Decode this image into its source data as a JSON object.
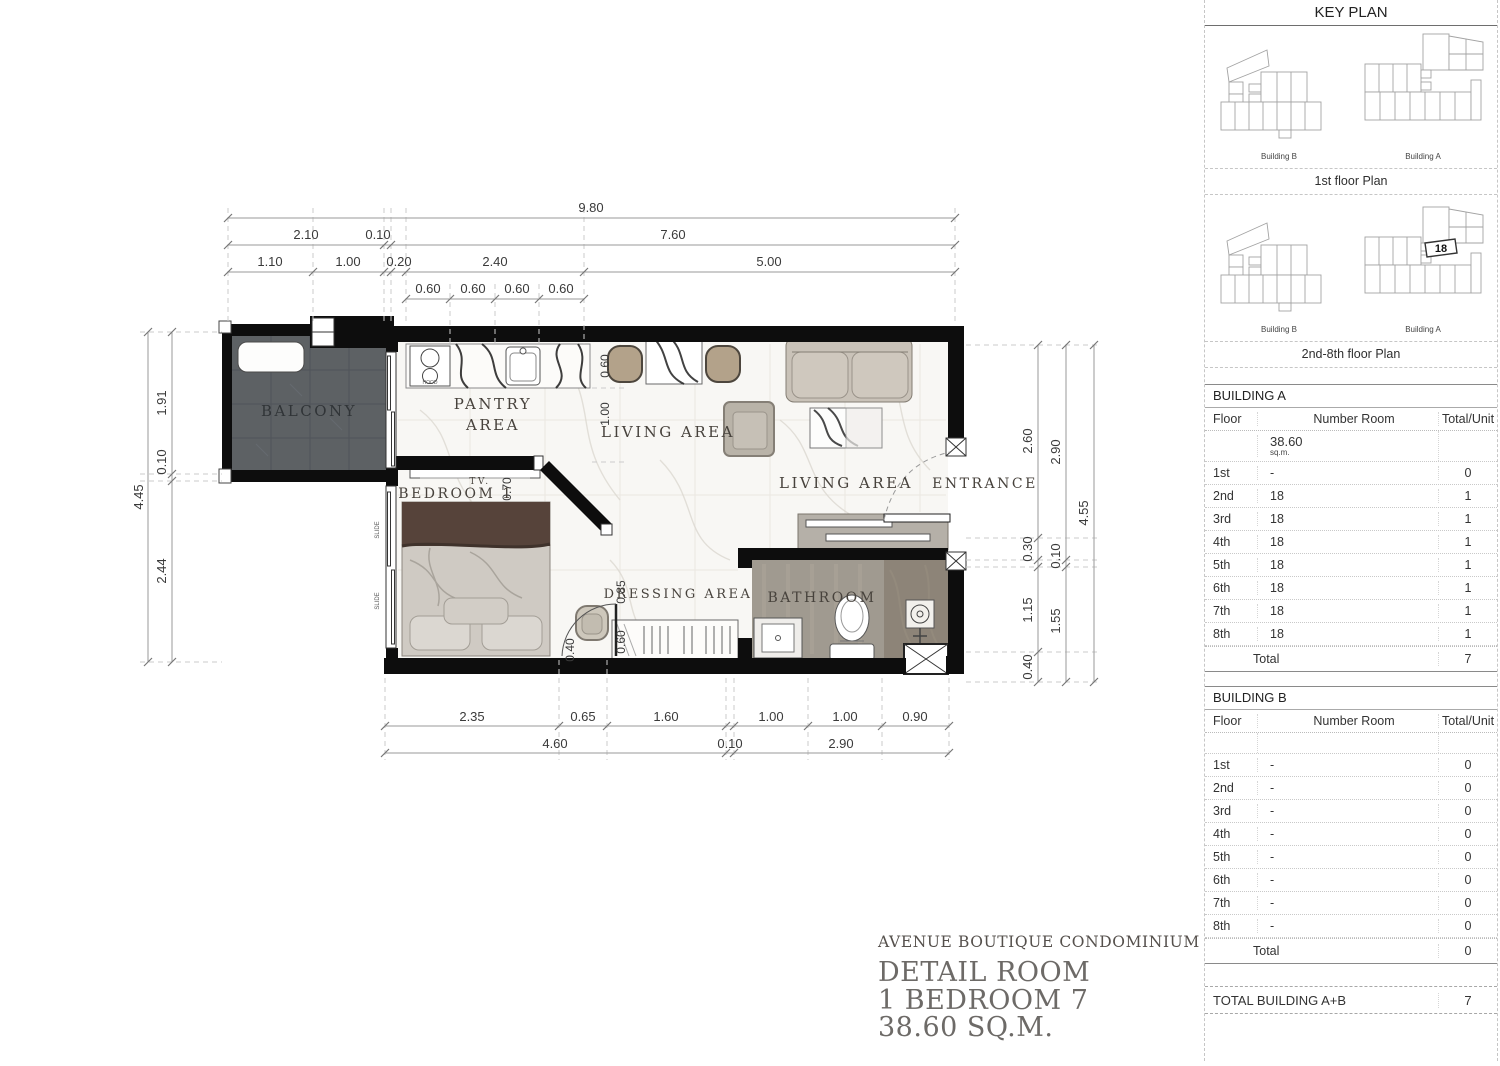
{
  "plan": {
    "rooms": {
      "balcony": "BALCONY",
      "pantry1": "PANTRY",
      "pantry2": "AREA",
      "living_top": "LIVING AREA",
      "living_main": "LIVING AREA",
      "entrance": "ENTRANCE",
      "bedroom": "BEDROOM 1",
      "dressing": "DRESSING AREA",
      "bathroom": "BATHROOM"
    },
    "annotations": {
      "tv": "TV.",
      "slide": "SLIDE",
      "hood": "HOOD"
    },
    "dims": {
      "top_total": "9.80",
      "top_r2": [
        "2.10",
        "0.10",
        "7.60"
      ],
      "top_r3": [
        "1.10",
        "1.00",
        "0.20",
        "2.40",
        "5.00"
      ],
      "top_r4": [
        "0.60",
        "0.60",
        "0.60",
        "0.60"
      ],
      "bottom_r1": [
        "2.35",
        "0.65",
        "1.60",
        "1.00",
        "1.00",
        "0.90"
      ],
      "bottom_r2": [
        "4.60",
        "0.10",
        "2.90"
      ],
      "left_total": "4.45",
      "left_inner": [
        "1.91",
        "0.10",
        "2.44"
      ],
      "right_inner": [
        "2.60",
        "0.30",
        "1.15",
        "0.40"
      ],
      "right_mid": [
        "2.90",
        "0.10",
        "1.55"
      ],
      "right_total": "4.55",
      "interior": {
        "pantry_depth": "0.60",
        "pantry_gap": "1.00",
        "tv": "0.70",
        "dressing": "0.85",
        "rack": "0.60",
        "bed_gap": "0.40"
      }
    }
  },
  "title_block": {
    "project": "AVENUE BOUTIQUE CONDOMINIUM",
    "line1": "DETAIL ROOM",
    "line2": "1 BEDROOM 7",
    "line3": "38.60 SQ.M."
  },
  "sidebar": {
    "title": "KEY PLAN",
    "plan1": {
      "caption": "1st floor Plan",
      "label_b": "Building B",
      "label_a": "Building A"
    },
    "plan2": {
      "caption": "2nd-8th floor Plan",
      "label_b": "Building B",
      "label_a": "Building A",
      "unit": "18"
    },
    "building_a": {
      "title": "BUILDING  A",
      "col_floor": "Floor",
      "col_room": "Number Room",
      "col_total": "Total/Unit",
      "area": "38.60",
      "area_unit": "sq.m.",
      "rows": [
        {
          "f": "1st",
          "r": "-",
          "u": "0"
        },
        {
          "f": "2nd",
          "r": "18",
          "u": "1"
        },
        {
          "f": "3rd",
          "r": "18",
          "u": "1"
        },
        {
          "f": "4th",
          "r": "18",
          "u": "1"
        },
        {
          "f": "5th",
          "r": "18",
          "u": "1"
        },
        {
          "f": "6th",
          "r": "18",
          "u": "1"
        },
        {
          "f": "7th",
          "r": "18",
          "u": "1"
        },
        {
          "f": "8th",
          "r": "18",
          "u": "1"
        }
      ],
      "total_label": "Total",
      "total_value": "7"
    },
    "building_b": {
      "title": "BUILDING  B",
      "col_floor": "Floor",
      "col_room": "Number Room",
      "col_total": "Total/Unit",
      "rows": [
        {
          "f": "1st",
          "r": "-",
          "u": "0"
        },
        {
          "f": "2nd",
          "r": "-",
          "u": "0"
        },
        {
          "f": "3rd",
          "r": "-",
          "u": "0"
        },
        {
          "f": "4th",
          "r": "-",
          "u": "0"
        },
        {
          "f": "5th",
          "r": "-",
          "u": "0"
        },
        {
          "f": "6th",
          "r": "-",
          "u": "0"
        },
        {
          "f": "7th",
          "r": "-",
          "u": "0"
        },
        {
          "f": "8th",
          "r": "-",
          "u": "0"
        }
      ],
      "total_label": "Total",
      "total_value": "0"
    },
    "grand": {
      "label": "TOTAL BUILDING  A+B",
      "value": "7"
    }
  },
  "colors": {
    "wall": "#0d0d0d",
    "balcony_floor": "#5d6164",
    "bathroom_floor": "#a09a90",
    "shower_floor": "#8d8478",
    "dim_text": "#3a3a3a",
    "room_text": "#47423c",
    "title_text": "#6d6a67"
  }
}
